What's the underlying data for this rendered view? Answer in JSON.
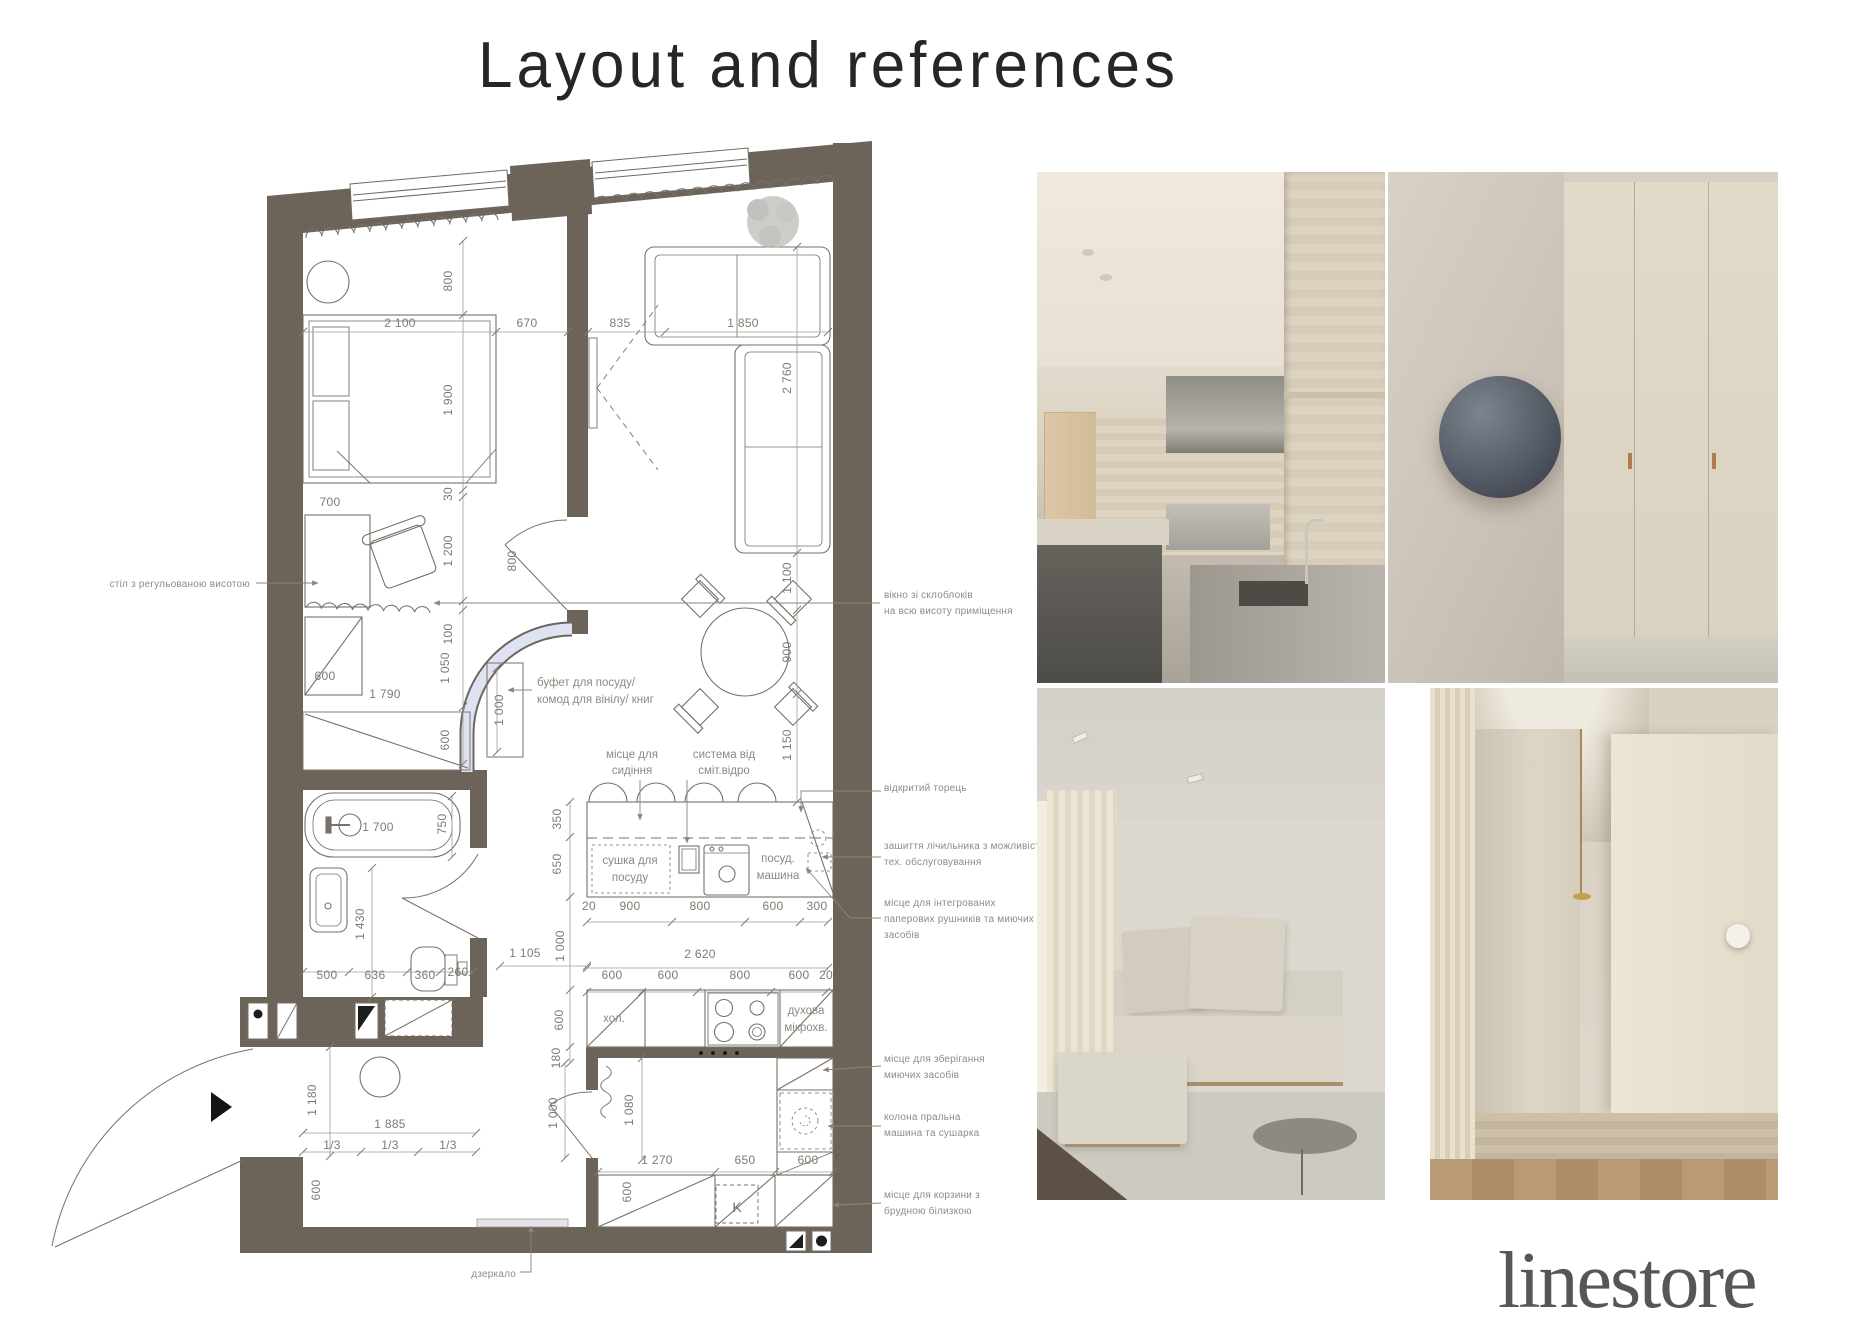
{
  "page": {
    "title": "Layout and references",
    "logo": "linestore"
  },
  "colors": {
    "wall": "#6d6459",
    "glass_block_window": "#dfe3f1",
    "plan_line": "#76716a",
    "dimension_text": "#7f7a71",
    "annotation_text": "#908b82",
    "title_text": "#262626",
    "logo_text": "#55565a"
  },
  "plan": {
    "dimensions": [
      {
        "t": "800",
        "x": 452,
        "y": 281,
        "r": -90
      },
      {
        "t": "2 100",
        "x": 400,
        "y": 327
      },
      {
        "t": "670",
        "x": 527,
        "y": 327
      },
      {
        "t": "835",
        "x": 620,
        "y": 327
      },
      {
        "t": "1 850",
        "x": 743,
        "y": 327
      },
      {
        "t": "1 900",
        "x": 452,
        "y": 400,
        "r": -90
      },
      {
        "t": "2 760",
        "x": 791,
        "y": 378,
        "r": -90
      },
      {
        "t": "30",
        "x": 452,
        "y": 494,
        "r": -90
      },
      {
        "t": "700",
        "x": 330,
        "y": 506
      },
      {
        "t": "1 200",
        "x": 452,
        "y": 551,
        "r": -90
      },
      {
        "t": "800",
        "x": 516,
        "y": 561,
        "r": -90
      },
      {
        "t": "1 100",
        "x": 791,
        "y": 578,
        "r": -90
      },
      {
        "t": "100",
        "x": 452,
        "y": 634,
        "r": -90
      },
      {
        "t": "900",
        "x": 791,
        "y": 652,
        "r": -90
      },
      {
        "t": "1 050",
        "x": 449,
        "y": 668,
        "r": -90
      },
      {
        "t": "600",
        "x": 325,
        "y": 680
      },
      {
        "t": "1 790",
        "x": 385,
        "y": 698
      },
      {
        "t": "1 000",
        "x": 503,
        "y": 710,
        "r": -90
      },
      {
        "t": "600",
        "x": 449,
        "y": 740,
        "r": -90
      },
      {
        "t": "1 150",
        "x": 791,
        "y": 745,
        "r": -90
      },
      {
        "t": "350",
        "x": 561,
        "y": 819,
        "r": -90
      },
      {
        "t": "1 700",
        "x": 378,
        "y": 831
      },
      {
        "t": "750",
        "x": 446,
        "y": 824,
        "r": -90
      },
      {
        "t": "650",
        "x": 561,
        "y": 864,
        "r": -90
      },
      {
        "t": "20",
        "x": 589,
        "y": 910
      },
      {
        "t": "900",
        "x": 630,
        "y": 910
      },
      {
        "t": "800",
        "x": 700,
        "y": 910
      },
      {
        "t": "600",
        "x": 773,
        "y": 910
      },
      {
        "t": "300",
        "x": 817,
        "y": 910
      },
      {
        "t": "1 430",
        "x": 364,
        "y": 924,
        "r": -90
      },
      {
        "t": "1 000",
        "x": 564,
        "y": 946,
        "r": -90
      },
      {
        "t": "1 105",
        "x": 525,
        "y": 957
      },
      {
        "t": "2 620",
        "x": 700,
        "y": 958
      },
      {
        "t": "500",
        "x": 327,
        "y": 979
      },
      {
        "t": "636",
        "x": 375,
        "y": 979
      },
      {
        "t": "360",
        "x": 425,
        "y": 979
      },
      {
        "t": "260",
        "x": 458,
        "y": 976
      },
      {
        "t": "600",
        "x": 612,
        "y": 979
      },
      {
        "t": "600",
        "x": 668,
        "y": 979
      },
      {
        "t": "800",
        "x": 740,
        "y": 979
      },
      {
        "t": "600",
        "x": 799,
        "y": 979
      },
      {
        "t": "20",
        "x": 826,
        "y": 979
      },
      {
        "t": "600",
        "x": 563,
        "y": 1020,
        "r": -90
      },
      {
        "t": "180",
        "x": 560,
        "y": 1058,
        "r": -90
      },
      {
        "t": "1 180",
        "x": 316,
        "y": 1100,
        "r": -90
      },
      {
        "t": "1 000",
        "x": 557,
        "y": 1113,
        "r": -90
      },
      {
        "t": "1 080",
        "x": 633,
        "y": 1110,
        "r": -90
      },
      {
        "t": "1 885",
        "x": 390,
        "y": 1128
      },
      {
        "t": "1/3",
        "x": 332,
        "y": 1149
      },
      {
        "t": "1/3",
        "x": 390,
        "y": 1149
      },
      {
        "t": "1/3",
        "x": 448,
        "y": 1149
      },
      {
        "t": "1 270",
        "x": 657,
        "y": 1164
      },
      {
        "t": "650",
        "x": 745,
        "y": 1164
      },
      {
        "t": "600",
        "x": 808,
        "y": 1164
      },
      {
        "t": "600",
        "x": 320,
        "y": 1190,
        "r": -90
      },
      {
        "t": "600",
        "x": 631,
        "y": 1192,
        "r": -90
      }
    ],
    "labels": [
      {
        "t": "буфет для посуду/",
        "x": 537,
        "y": 686,
        "a": "s"
      },
      {
        "t": "комод для вінілу/ книг",
        "x": 537,
        "y": 703,
        "a": "s"
      },
      {
        "t": "місце для",
        "x": 632,
        "y": 758
      },
      {
        "t": "сидіння",
        "x": 632,
        "y": 774
      },
      {
        "t": "система від",
        "x": 724,
        "y": 758
      },
      {
        "t": "сміт.відро",
        "x": 724,
        "y": 774
      },
      {
        "t": "сушка для",
        "x": 630,
        "y": 864
      },
      {
        "t": "посуду",
        "x": 630,
        "y": 881
      },
      {
        "t": "посуд.",
        "x": 778,
        "y": 862
      },
      {
        "t": "машина",
        "x": 778,
        "y": 879
      },
      {
        "t": "хол.",
        "x": 614,
        "y": 1022
      },
      {
        "t": "духова",
        "x": 806,
        "y": 1014
      },
      {
        "t": "мікрохв.",
        "x": 806,
        "y": 1031
      },
      {
        "t": "K",
        "x": 737,
        "y": 1212,
        "cls": "kbox"
      }
    ],
    "callouts": [
      {
        "t": "стіл з регульованою висотою",
        "x": 250,
        "y": 587,
        "a": "e"
      },
      {
        "t": "вікно зі склоблоків",
        "x": 884,
        "y": 598,
        "a": "s"
      },
      {
        "t": "на всю висоту приміщення",
        "x": 884,
        "y": 614,
        "a": "s"
      },
      {
        "t": "відкритий торець",
        "x": 884,
        "y": 791,
        "a": "s"
      },
      {
        "t": "зашиття лічильника з можливістю",
        "x": 884,
        "y": 849,
        "a": "s"
      },
      {
        "t": "тех. обслуговування",
        "x": 884,
        "y": 865,
        "a": "s"
      },
      {
        "t": "місце для інтегрованих",
        "x": 884,
        "y": 906,
        "a": "s"
      },
      {
        "t": "паперових рушників та миючих",
        "x": 884,
        "y": 922,
        "a": "s"
      },
      {
        "t": "засобів",
        "x": 884,
        "y": 938,
        "a": "s"
      },
      {
        "t": "місце для зберігання",
        "x": 884,
        "y": 1062,
        "a": "s"
      },
      {
        "t": "миючих засобів",
        "x": 884,
        "y": 1078,
        "a": "s"
      },
      {
        "t": "колона пральна",
        "x": 884,
        "y": 1120,
        "a": "s"
      },
      {
        "t": "машина та сушарка",
        "x": 884,
        "y": 1136,
        "a": "s"
      },
      {
        "t": "місце для корзини з",
        "x": 884,
        "y": 1198,
        "a": "s"
      },
      {
        "t": "брудною білизкою",
        "x": 884,
        "y": 1214,
        "a": "s"
      },
      {
        "t": "дзеркало",
        "x": 516,
        "y": 1277,
        "a": "e"
      }
    ]
  }
}
